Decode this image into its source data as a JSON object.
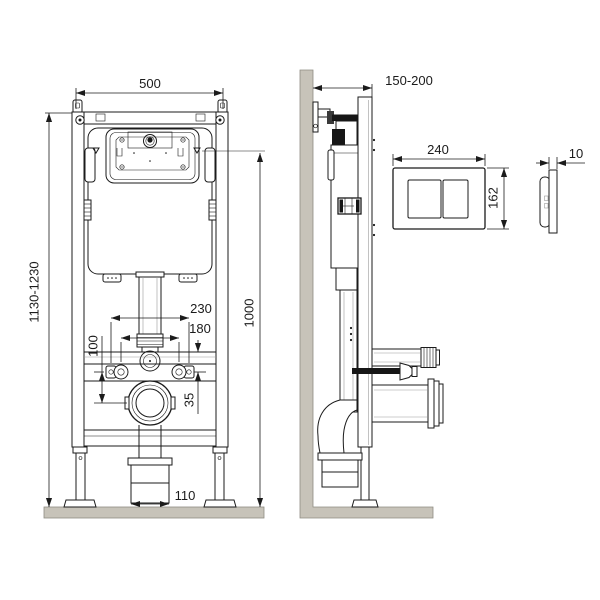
{
  "drawing": {
    "type": "technical-installation-diagram",
    "subject": "wall-mounted WC installation frame with concealed cistern and dual-flush plate",
    "views": {
      "front_view": {
        "name": "frame front view",
        "dimensions": {
          "frame_width": "500",
          "frame_height_range": "1130-1230",
          "upper_level_height": "1000",
          "fixing_holes_outer": "230",
          "fixing_holes_inner": "180",
          "bolt_to_drain_offset": "100",
          "rail_to_bolt_offset": "35",
          "drain_box_width": "110"
        }
      },
      "side_view": {
        "name": "frame side view at wall",
        "dimensions": {
          "frame_depth_range": "150-200"
        }
      },
      "flush_plate_front": {
        "name": "flush plate front view",
        "dimensions": {
          "plate_width": "240",
          "plate_height": "162"
        }
      },
      "flush_plate_side": {
        "name": "flush plate side view",
        "dimensions": {
          "plate_thickness": "10"
        }
      }
    }
  },
  "colors": {
    "line": "#1b1b1b",
    "masonry_fill": "#c7c3b9",
    "masonry_edge": "#8f8c83",
    "background": "#ffffff"
  }
}
